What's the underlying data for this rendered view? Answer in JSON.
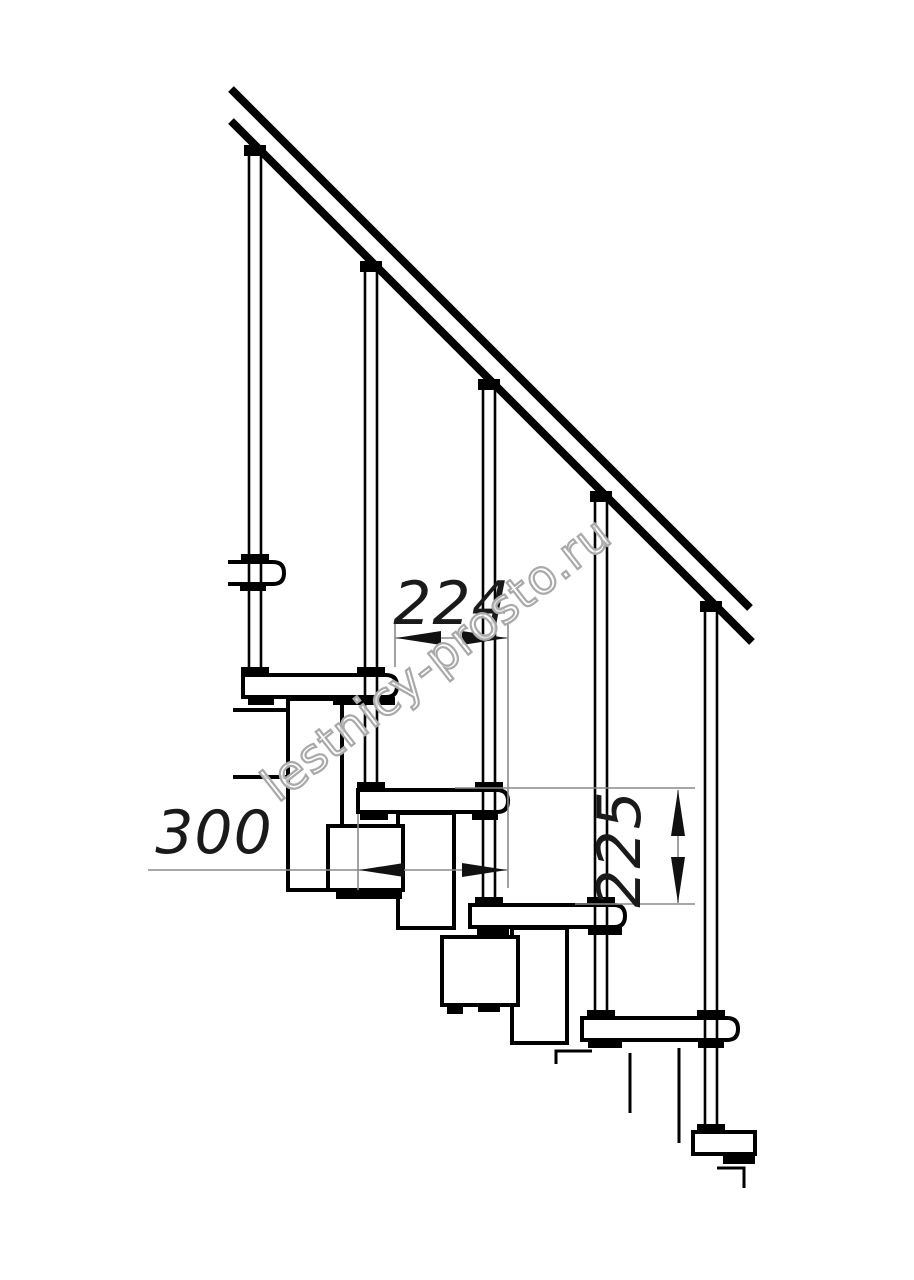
{
  "watermark": {
    "text": "lestnicy-prosto.ru"
  },
  "dimensions": {
    "step_run": {
      "value": "224"
    },
    "tread_depth": {
      "value": "300"
    },
    "step_rise": {
      "value": "225"
    }
  },
  "colors": {
    "ink": "#000000",
    "dim_line": "#8a8a8a",
    "dim_text": "#1a1a1a",
    "watermark_outline": "#a9a9a9",
    "background": "#ffffff"
  }
}
